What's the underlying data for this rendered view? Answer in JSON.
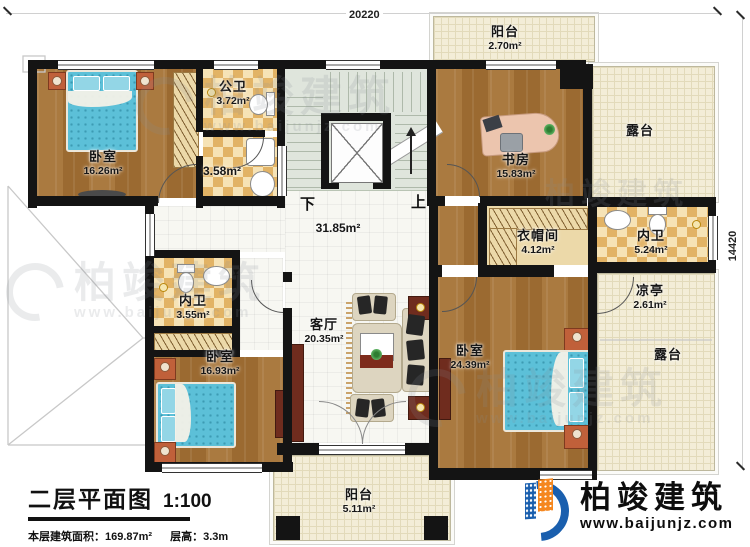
{
  "title_block": {
    "title": "二层平面图",
    "scale": "1:100",
    "area_label": "本层建筑面积：169.87m²",
    "floor_height_label": "层高：3.3m"
  },
  "dimensions": {
    "top": "20220",
    "right": "14420"
  },
  "circulation": {
    "down": "下",
    "up": "上",
    "hall_area": "31.85m²"
  },
  "rooms": [
    {
      "name": "卧室",
      "area": "16.26m²"
    },
    {
      "name": "公卫",
      "area": "3.72m²"
    },
    {
      "name": "",
      "area": "3.58m²"
    },
    {
      "name": "书房",
      "area": "15.83m²"
    },
    {
      "name": "阳台",
      "area": "2.70m²"
    },
    {
      "name": "露台",
      "area": ""
    },
    {
      "name": "衣帽间",
      "area": "4.12m²"
    },
    {
      "name": "内卫",
      "area": "5.24m²"
    },
    {
      "name": "凉亭",
      "area": "2.61m²"
    },
    {
      "name": "露台",
      "area": ""
    },
    {
      "name": "内卫",
      "area": "3.55m²"
    },
    {
      "name": "卧室",
      "area": "16.93m²"
    },
    {
      "name": "客厅",
      "area": "20.35m²"
    },
    {
      "name": "卧室",
      "area": "24.39m²"
    },
    {
      "name": "阳台",
      "area": "5.11m²"
    }
  ],
  "brand": {
    "name": "柏竣建筑",
    "website": "www.baijunjz.com"
  },
  "colors": {
    "wall": "#141414",
    "wood": "#a5763c",
    "tile": "#e2b365",
    "terrace": "#f3edd7",
    "bed": "#5cc0d8",
    "logo_blue": "#1a5fae",
    "logo_orange": "#f5871f"
  }
}
